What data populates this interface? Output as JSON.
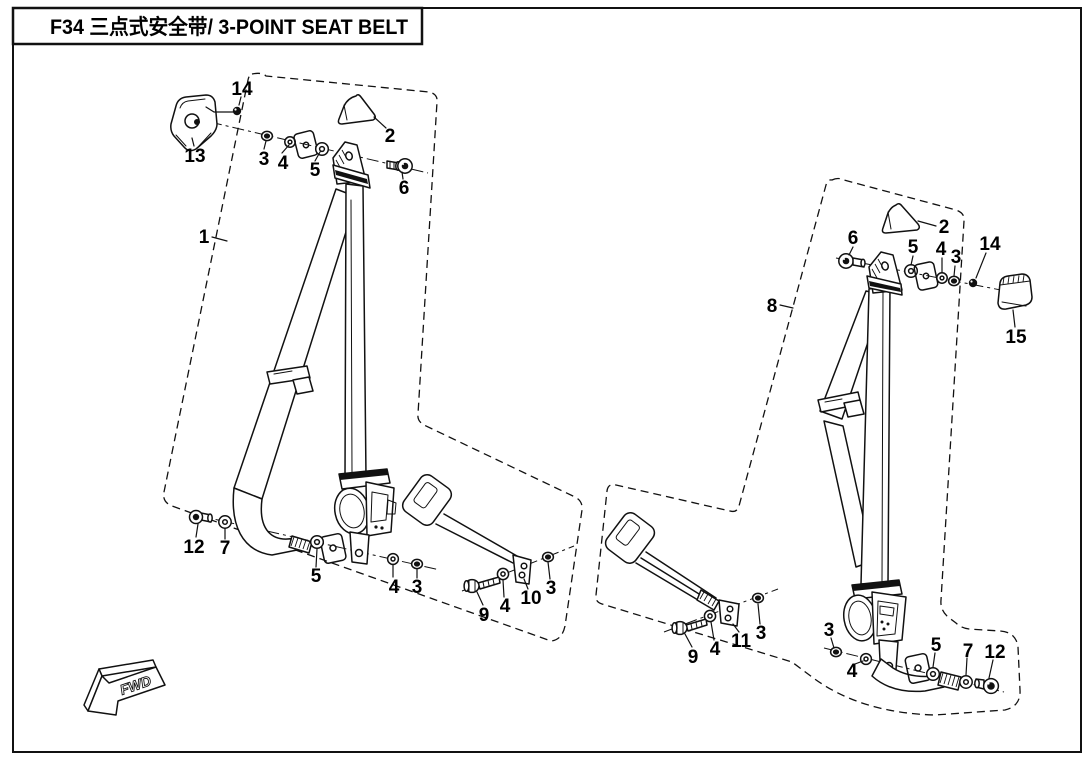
{
  "page": {
    "background": "#ffffff",
    "ink": "#111111"
  },
  "title_block": {
    "text": "F34  三点式安全带/ 3-POINT SEAT BELT"
  },
  "orientation": {
    "label": "FWD"
  },
  "callouts": {
    "l1": "1",
    "l2": "2",
    "l3a": "3",
    "l4a": "4",
    "l5a": "5",
    "l6": "6",
    "l13": "13",
    "l14": "14",
    "l12": "12",
    "l7": "7",
    "l5b": "5",
    "l4b": "4",
    "l3b": "3",
    "l9": "9",
    "l4c": "4",
    "l10": "10",
    "l3c": "3",
    "r8": "8",
    "r2": "2",
    "r6": "6",
    "r5a": "5",
    "r4a": "4",
    "r3a": "3",
    "r14": "14",
    "r15": "15",
    "r9": "9",
    "r4b": "4",
    "r11": "11",
    "r3b": "3",
    "r3c": "3",
    "r4c": "4",
    "r5c": "5",
    "r7": "7",
    "r12": "12"
  }
}
